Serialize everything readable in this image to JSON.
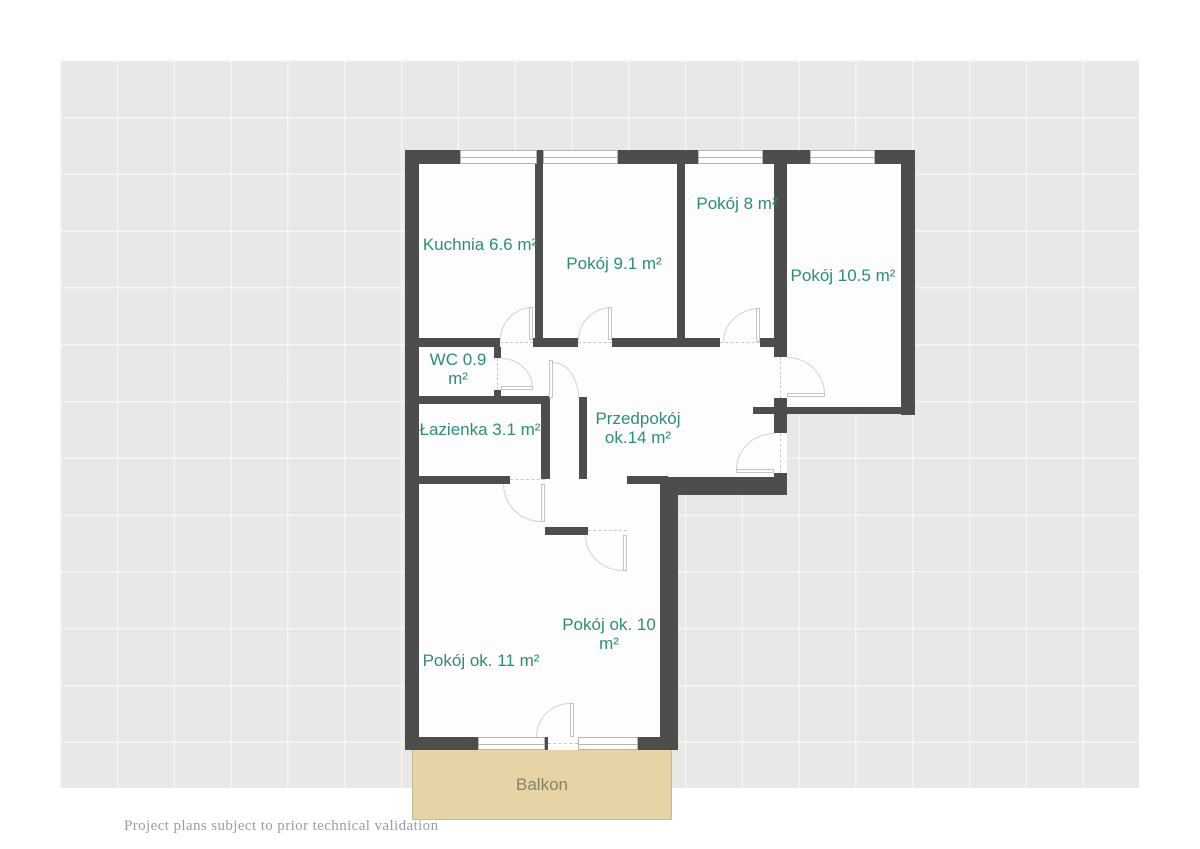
{
  "plan": {
    "rooms": [
      {
        "id": "kuchnia",
        "label": "Kuchnia 6.6 m²"
      },
      {
        "id": "pokoj-9-1",
        "label": "Pokój 9.1 m²"
      },
      {
        "id": "pokoj-8",
        "label": "Pokój 8 m²"
      },
      {
        "id": "pokoj-10-5",
        "label": "Pokój 10.5 m²"
      },
      {
        "id": "wc",
        "label": "WC 0.9 m²"
      },
      {
        "id": "lazienka",
        "label": "Łazienka 3.1 m²"
      },
      {
        "id": "przedpokoj",
        "label": "Przedpokój ok.14 m²"
      },
      {
        "id": "pokoj-11",
        "label": "Pokój ok. 11 m²"
      },
      {
        "id": "pokoj-10",
        "label": "Pokój ok. 10 m²"
      },
      {
        "id": "balkon",
        "label": "Balkon"
      }
    ],
    "disclaimer": "Project plans subject to prior technical validation",
    "colors": {
      "wall": "#4d4d4c",
      "label": "#2e8e74",
      "canvas": "#e8e8e7",
      "room_fill": "#fdfdfd",
      "balcony_fill": "#e5d4a5",
      "balcony_border": "#c9b98b",
      "balcony_text": "#8c8165",
      "disclaimer_text": "#96a0a0",
      "door_stroke": "#d2d2d2",
      "window_stroke": "#b5b5b5"
    }
  }
}
